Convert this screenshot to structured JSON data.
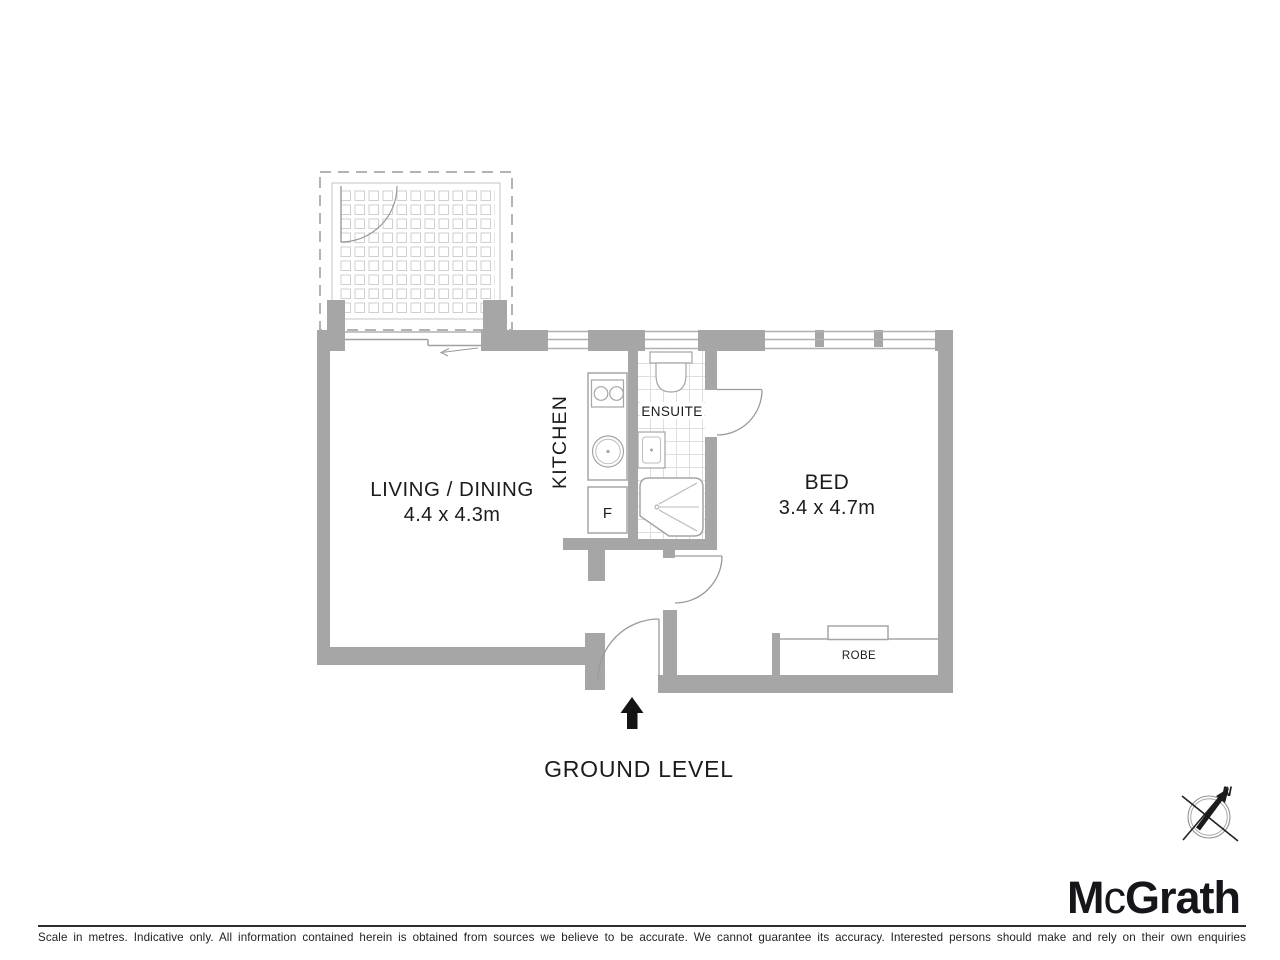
{
  "floorplan": {
    "level_label": "GROUND LEVEL",
    "rooms": {
      "living": {
        "label": "LIVING / DINING",
        "dims": "4.4 x 4.3m"
      },
      "kitchen": {
        "label": "KITCHEN"
      },
      "ensuite": {
        "label": "ENSUITE"
      },
      "bed": {
        "label": "BED",
        "dims": "3.4 x 4.7m"
      },
      "robe": {
        "label": "ROBE"
      },
      "fridge": {
        "label": "F"
      }
    },
    "compass": {
      "north_label": "N"
    }
  },
  "branding": {
    "logo_m": "M",
    "logo_c": "c",
    "logo_rest": "Grath"
  },
  "footer": {
    "disclaimer": "Scale in metres. Indicative only. All information contained herein is obtained from sources we believe to be accurate. We cannot guarantee its accuracy. Interested persons should make and rely on their own enquiries"
  },
  "colors": {
    "wall": "#a6a6a6",
    "fixture_line": "#a5a5a5",
    "tile_line": "#dedede",
    "text": "#1c1c1c",
    "arrow": "#141414",
    "logo": "#16161a"
  }
}
